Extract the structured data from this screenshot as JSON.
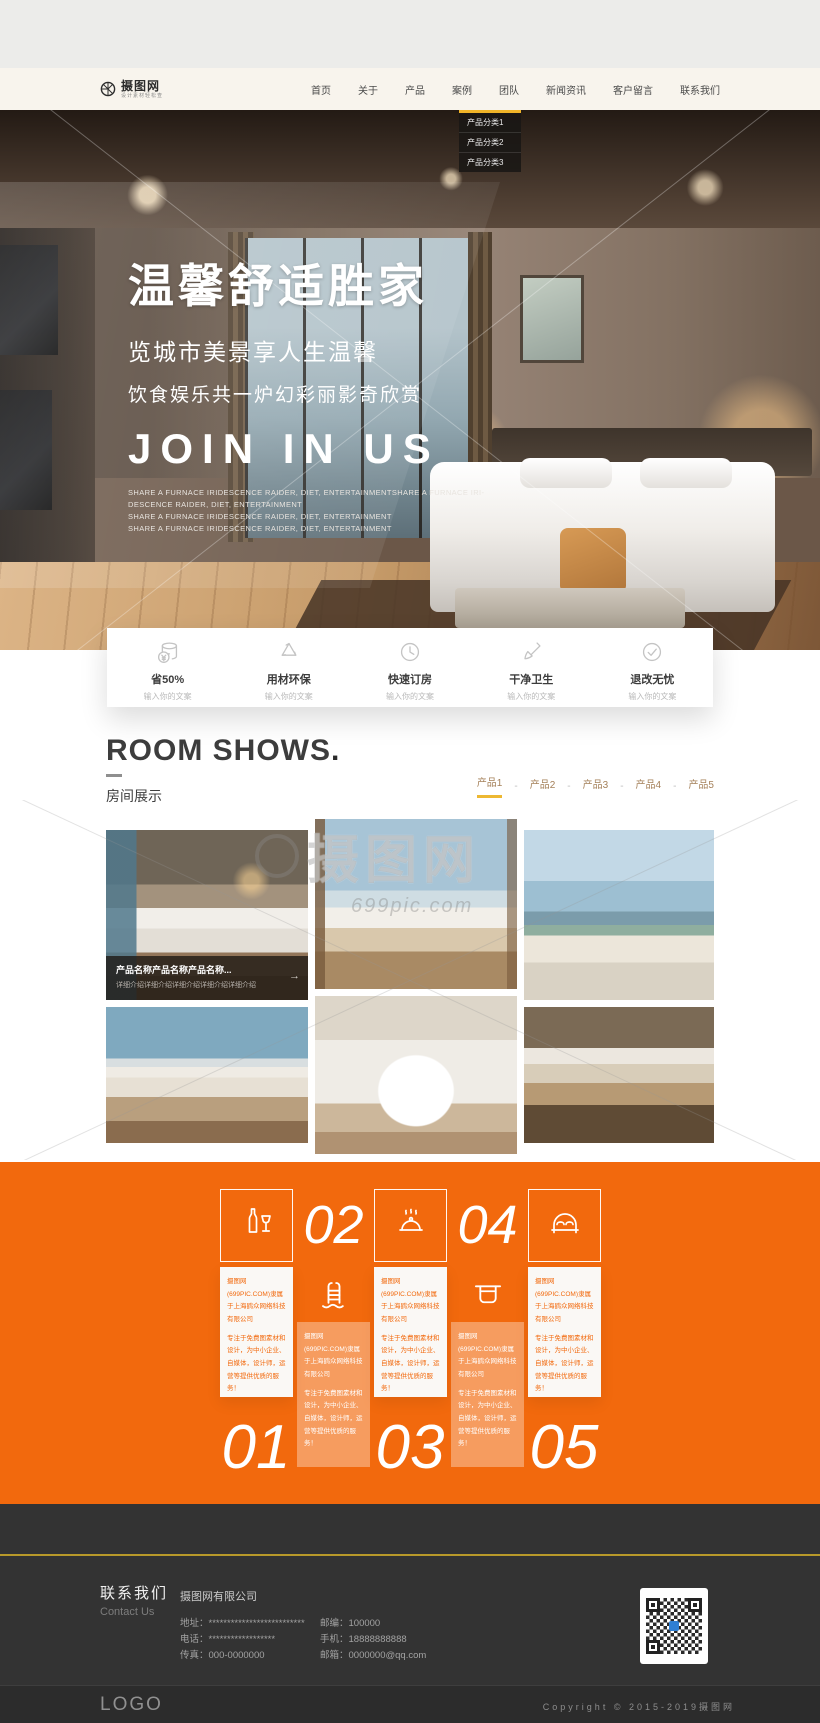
{
  "colors": {
    "accent_orange": "#f2690d",
    "accent_yellow": "#f0b428",
    "header_bg": "#f8f4ed",
    "footer_bg": "#333333"
  },
  "header": {
    "logo_text": "摄图网",
    "logo_tagline": "设计素材轻松查",
    "nav": [
      {
        "label": "首页"
      },
      {
        "label": "关于"
      },
      {
        "label": "产品"
      },
      {
        "label": "案例"
      },
      {
        "label": "团队"
      },
      {
        "label": "新闻资讯"
      },
      {
        "label": "客户留言"
      },
      {
        "label": "联系我们"
      }
    ]
  },
  "dropdown": {
    "items": [
      {
        "label": "产品分类1"
      },
      {
        "label": "产品分类2"
      },
      {
        "label": "产品分类3"
      }
    ]
  },
  "hero": {
    "title": "温馨舒适胜家",
    "subtitle1": "览城市美景享人生温馨",
    "subtitle2": "饮食娱乐共一炉幻彩丽影奇欣赏",
    "headline_en": "JOIN IN US",
    "desc_lines": [
      "SHARE A FURNACE IRIDESCENCE RAIDER, DIET, ENTERTAINMENTSHARE A FURNACE IRI-",
      "DESCENCE RAIDER, DIET, ENTERTAINMENT",
      "SHARE A FURNACE IRIDESCENCE RAIDER, DIET, ENTERTAINMENT",
      "SHARE A FURNACE IRIDESCENCE RAIDER, DIET, ENTERTAINMENT"
    ]
  },
  "features": {
    "items": [
      {
        "icon": "coins-icon",
        "title": "省50%",
        "sub": "输入你的文案"
      },
      {
        "icon": "recycle-icon",
        "title": "用材环保",
        "sub": "输入你的文案"
      },
      {
        "icon": "clock-icon",
        "title": "快速订房",
        "sub": "输入你的文案"
      },
      {
        "icon": "brush-icon",
        "title": "干净卫生",
        "sub": "输入你的文案"
      },
      {
        "icon": "check-icon",
        "title": "退改无忧",
        "sub": "输入你的文案"
      }
    ]
  },
  "room_shows": {
    "title_en": "ROOM SHOWS",
    "title_dot": ".",
    "title_cn": "房间展示",
    "sep": "-",
    "tabs": [
      {
        "label": "产品1",
        "active": true
      },
      {
        "label": "产品2"
      },
      {
        "label": "产品3"
      },
      {
        "label": "产品4"
      },
      {
        "label": "产品5"
      }
    ]
  },
  "gallery": {
    "caption_title": "产品名称产品名称产品名称...",
    "caption_desc": "详细介绍详细介绍详细介绍详细介绍详细介绍",
    "caption_arrow": "→",
    "watermark_text": "摄图网",
    "watermark_url": "699pic.com"
  },
  "promo": {
    "numbers": [
      "01",
      "02",
      "03",
      "04",
      "05"
    ],
    "card_line1": "摄图网(699PIC.COM)隶属于上海鹍众网络科技有限公司",
    "card_line2": "专注于免费图素材和设计，为中小企业、自媒体，设计师，运营等提供优质的服务！"
  },
  "footer": {
    "contact_cn": "联系我们",
    "contact_en": "Contact Us",
    "company": "摄图网有限公司",
    "info_left": [
      {
        "label": "地址：",
        "value": "**************************"
      },
      {
        "label": "电话：",
        "value": "******************"
      },
      {
        "label": "传真：",
        "value": "000-0000000"
      }
    ],
    "info_right": [
      {
        "label": "邮编：",
        "value": "100000"
      },
      {
        "label": "手机：",
        "value": "18888888888"
      },
      {
        "label": "邮箱：",
        "value": "0000000@qq.com"
      }
    ],
    "logo": "LOGO",
    "copyright": "Copyright © 2015-2019摄图网"
  }
}
